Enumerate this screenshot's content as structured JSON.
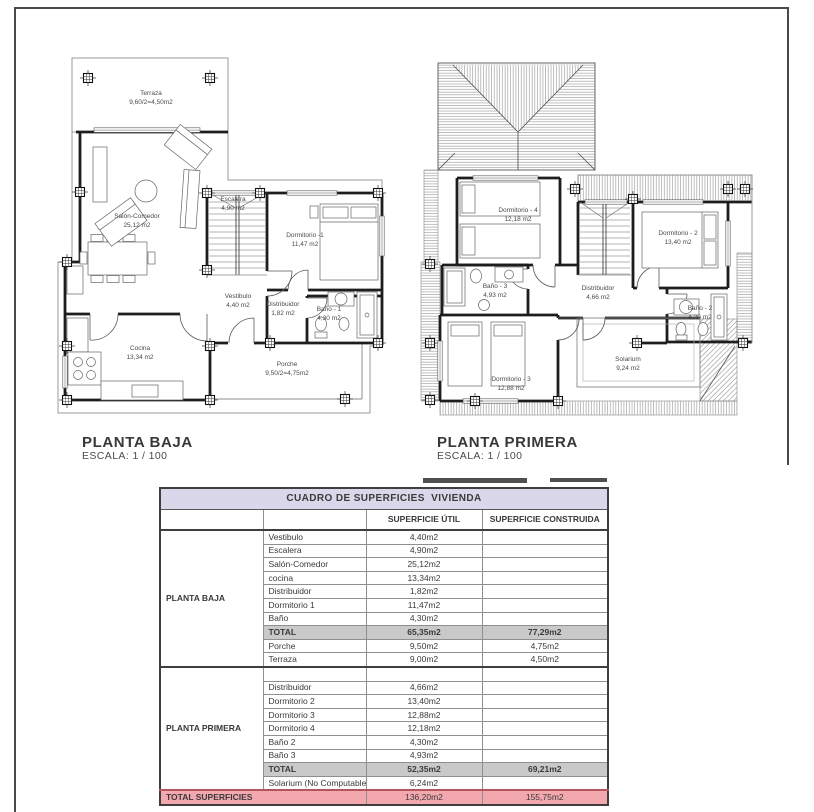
{
  "plans": [
    {
      "title": "PLANTA BAJA",
      "scale": "ESCALA: 1 / 100",
      "rooms": [
        {
          "name": "Terraza",
          "area": "9,60/2=4,50m2"
        },
        {
          "name": "Salón-Comedor",
          "area": "25,12 m2"
        },
        {
          "name": "Escalera",
          "area": "4,90 m2"
        },
        {
          "name": "Dormitorio -1",
          "area": "11,47 m2"
        },
        {
          "name": "Vestibulo",
          "area": "4,40 m2"
        },
        {
          "name": "Distribuidor",
          "area": "1,82 m2"
        },
        {
          "name": "Baño - 1",
          "area": "4,30 m2"
        },
        {
          "name": "Cocina",
          "area": "13,34 m2"
        },
        {
          "name": "Porche",
          "area": "9,50/2=4,75m2"
        }
      ]
    },
    {
      "title": "PLANTA PRIMERA",
      "scale": "ESCALA: 1 / 100",
      "rooms": [
        {
          "name": "Dormitorio - 4",
          "area": "12,18 m2"
        },
        {
          "name": "Dormitorio - 2",
          "area": "13,40 m2"
        },
        {
          "name": "Baño - 3",
          "area": "4,93 m2"
        },
        {
          "name": "Distribuidor",
          "area": "4,66 m2"
        },
        {
          "name": "Baño - 2",
          "area": "4,30 m2"
        },
        {
          "name": "Dormitorio - 3",
          "area": "12,88 m2"
        },
        {
          "name": "Solarium",
          "area": "9,24 m2"
        }
      ]
    }
  ],
  "table": {
    "title": "CUADRO DE SUPERFICIES  VIVIENDA",
    "columns": [
      "SUPERFICIE    ÚTIL",
      "SUPERFICIE CONSTRUIDA"
    ],
    "sections": [
      {
        "floor": "PLANTA BAJA",
        "rows": [
          {
            "name": "Vestibulo",
            "util": "4,40m2",
            "construida": ""
          },
          {
            "name": "Escalera",
            "util": "4,90m2",
            "construida": ""
          },
          {
            "name": "Salón-Comedor",
            "util": "25,12m2",
            "construida": ""
          },
          {
            "name": "cocina",
            "util": "13,34m2",
            "construida": ""
          },
          {
            "name": "Distribuidor",
            "util": "1,82m2",
            "construida": ""
          },
          {
            "name": "Dormitorio 1",
            "util": "11,47m2",
            "construida": ""
          },
          {
            "name": "Baño",
            "util": "4,30m2",
            "construida": ""
          },
          {
            "name": "TOTAL",
            "util": "65,35m2",
            "construida": "77,29m2",
            "total": true
          },
          {
            "name": "Porche",
            "util": "9,50m2",
            "construida": "4,75m2"
          },
          {
            "name": "Terraza",
            "util": "9,00m2",
            "construida": "4,50m2"
          }
        ]
      },
      {
        "floor": "PLANTA PRIMERA",
        "rows": [
          {
            "name": "",
            "util": "",
            "construida": "",
            "spacer": true
          },
          {
            "name": "Distribuidor",
            "util": "4,66m2",
            "construida": ""
          },
          {
            "name": "Dormitorio 2",
            "util": "13,40m2",
            "construida": ""
          },
          {
            "name": "Dormitorio 3",
            "util": "12,88m2",
            "construida": ""
          },
          {
            "name": "Dormitorio 4",
            "util": "12,18m2",
            "construida": ""
          },
          {
            "name": "Baño 2",
            "util": "4,30m2",
            "construida": ""
          },
          {
            "name": "Baño 3",
            "util": "4,93m2",
            "construida": ""
          },
          {
            "name": "TOTAL",
            "util": "52,35m2",
            "construida": "69,21m2",
            "total": true
          },
          {
            "name": "Solarium (No Computable)",
            "util": "6,24m2",
            "construida": ""
          }
        ]
      }
    ],
    "grand_total": {
      "label": "TOTAL SUPERFICIES",
      "util": "136,20m2",
      "construida": "155,75m2"
    }
  },
  "colors": {
    "table_title_bg": "#d9d7e9",
    "total_row_bg": "#c9c9c9",
    "grand_total_bg": "#f3a8af",
    "grand_total_border": "#b2565a",
    "line": "#1d1d1d"
  }
}
